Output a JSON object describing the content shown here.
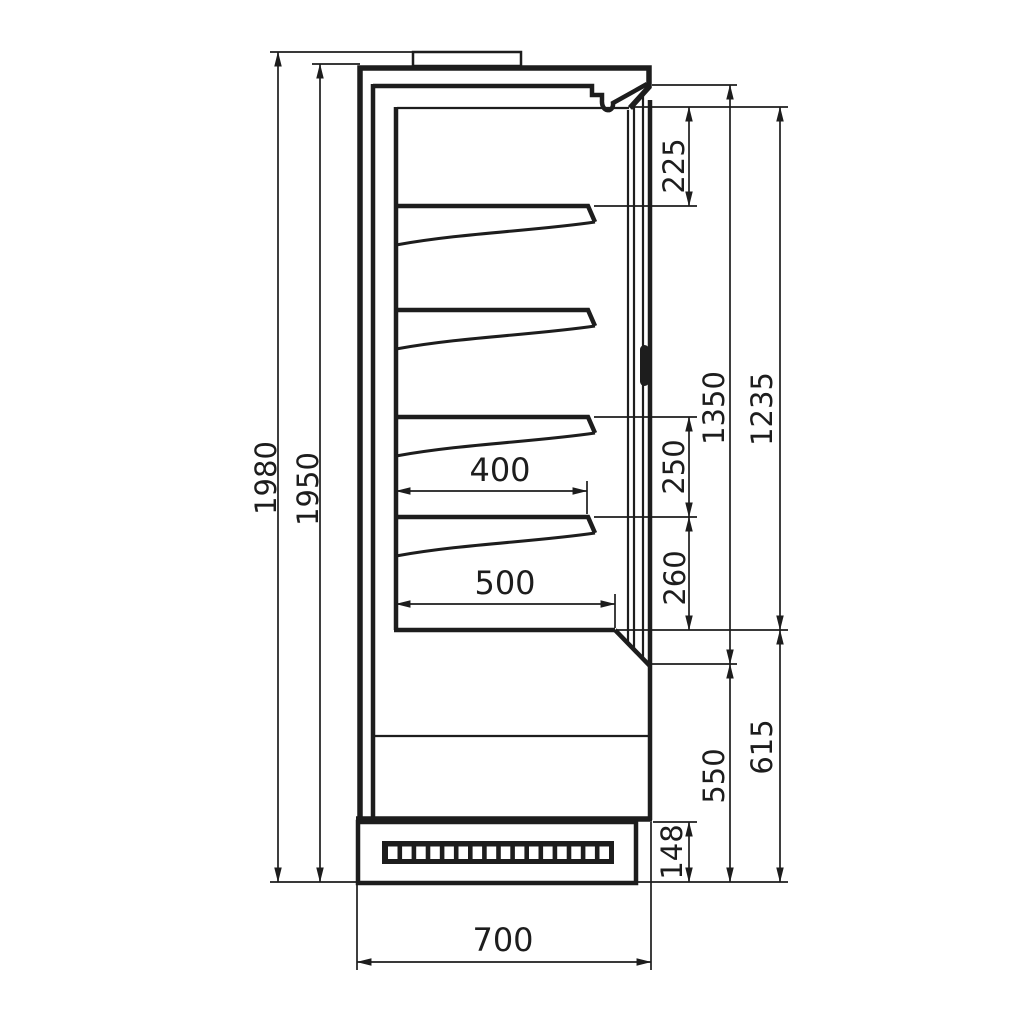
{
  "drawing": {
    "kind": "technical side-section drawing of an upright refrigerated display cabinet",
    "colors": {
      "line": "#1d1d1d",
      "background": "#ffffff"
    },
    "grille_slot_count": 16,
    "dimensions": {
      "overall_height": "1980",
      "body_height": "1950",
      "top_duct_zone": "225",
      "opening_height": "1350",
      "interior_height": "1235",
      "shelf_spacing_upper": "250",
      "shelf_spacing_lower": "260",
      "shelf_depth": "400",
      "bottom_shelf_depth": "500",
      "lower_front_height": "550",
      "base_zone_height": "615",
      "plinth_height": "148",
      "overall_depth": "700"
    }
  }
}
